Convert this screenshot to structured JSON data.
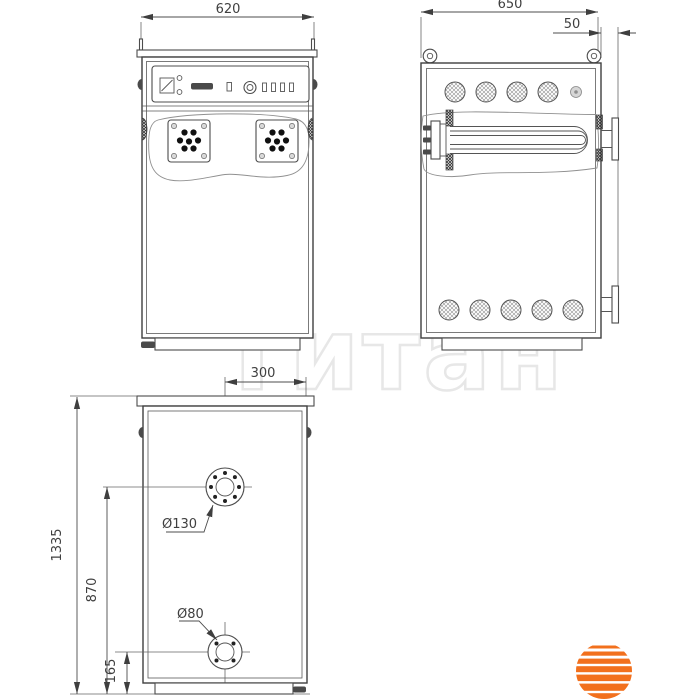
{
  "dimensions": {
    "front_width": "620",
    "side_depth": "650",
    "side_offset": "50",
    "rear_flange_offset": "300",
    "total_height": "1335",
    "upper_flange_height": "870",
    "lower_flange_height": "165"
  },
  "labels": {
    "upper_flange_diameter": "Ø130",
    "lower_flange_diameter": "Ø80"
  },
  "watermark": {
    "text": "Титан"
  },
  "colors": {
    "line": "#4c4c4c",
    "dimension_text": "#3f3f3f",
    "watermark": "#e7e7e7",
    "logo_orange": "#f2701d"
  }
}
